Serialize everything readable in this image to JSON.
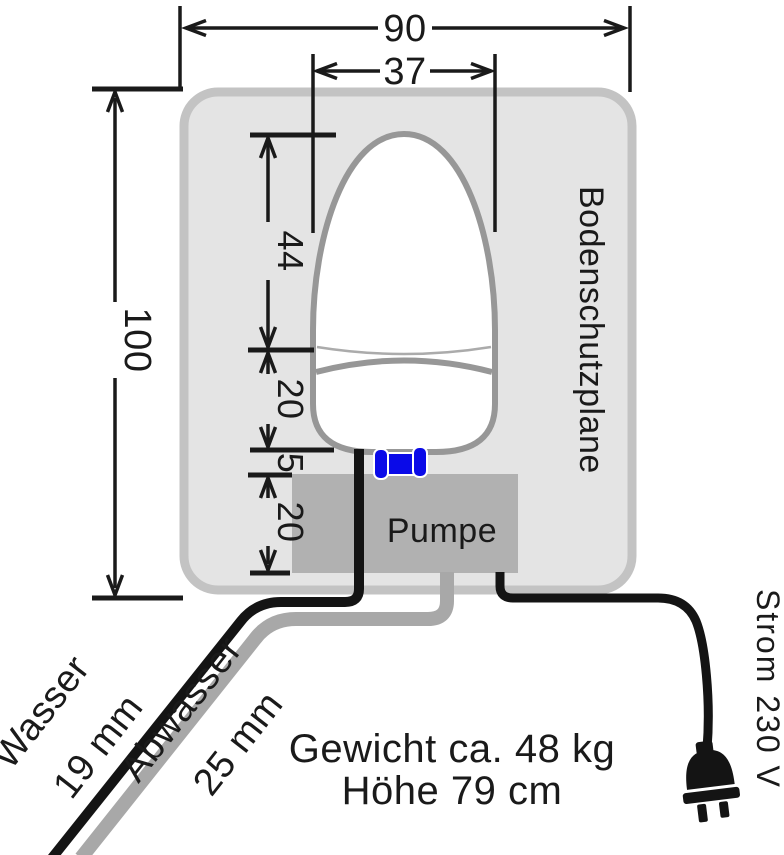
{
  "diagram": {
    "dimensions": {
      "overall_width": "90",
      "seat_width": "37",
      "overall_depth": "100",
      "seat_depth": "44",
      "tank_depth": "20",
      "gap": "5",
      "pump_depth": "20"
    },
    "labels": {
      "mat": "Bodenschutzplane",
      "pump": "Pumpe",
      "water": "Wasser",
      "water_size": "19 mm",
      "waste": "Abwasser",
      "waste_size": "25 mm",
      "power": "Strom 230 V",
      "weight": "Gewicht ca. 48 kg",
      "height": "Höhe 79 cm"
    },
    "colors": {
      "mat_fill": "#e4e4e4",
      "mat_border": "#c3c3c3",
      "pump_fill": "#b1b1b1",
      "outline_gray": "#979797",
      "hose_gray": "#a8a8a8",
      "hose_black": "#141414",
      "connector_blue": "#0a0ae8",
      "ink": "#1a1a1a"
    }
  }
}
